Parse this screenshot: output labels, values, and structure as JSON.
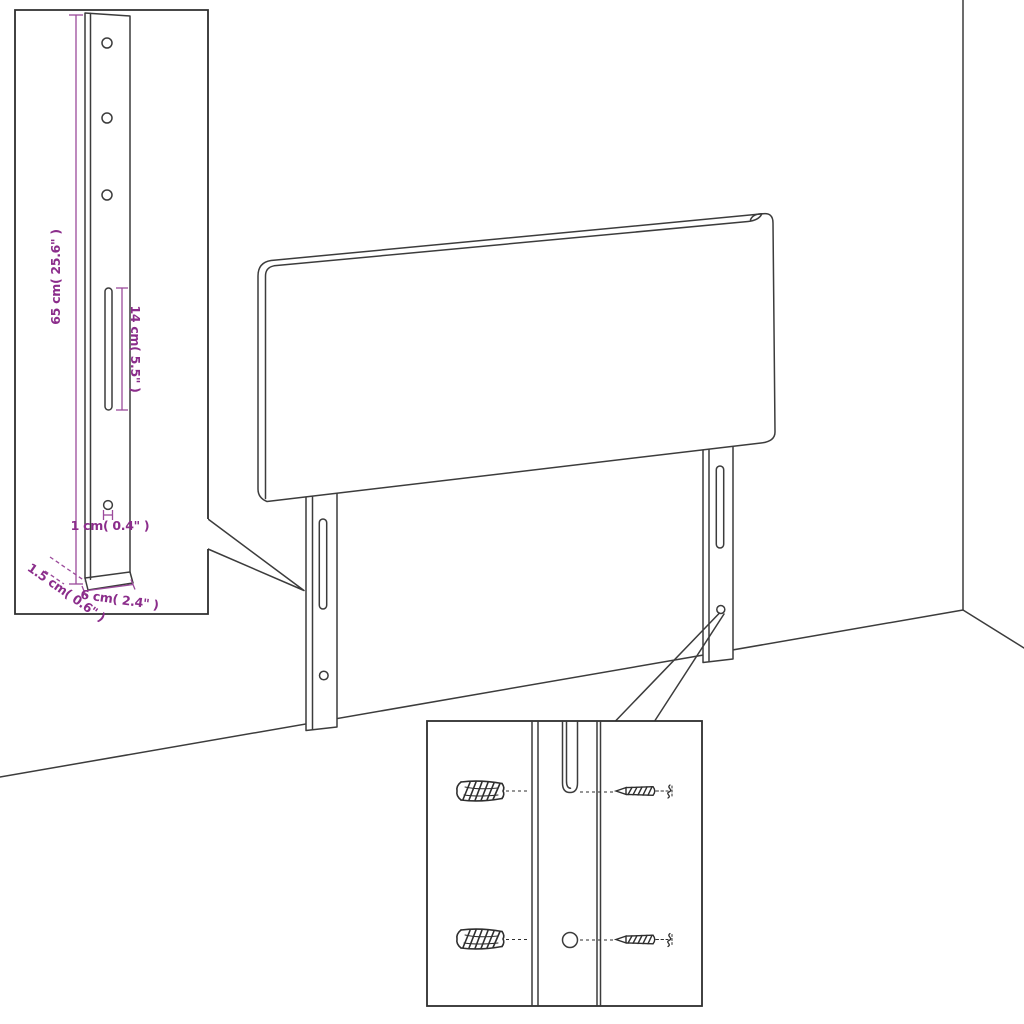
{
  "diagram": {
    "type": "furniture-assembly-dimension-diagram",
    "subject": "headboard with two mounting legs in room corner"
  },
  "colors": {
    "background": "#ffffff",
    "line": "#3c3c3c",
    "detail_box_border": "#2e2e2e",
    "dimension_line": "#9b4a9b",
    "dimension_text": "#8b2d8b"
  },
  "annotations": {
    "height": "65 cm( 25.6\" )",
    "slot_length": "14 cm( 5.5\" )",
    "hole_diameter": "1 cm( 0.4\" )",
    "depth": "1.5 cm( 0.6\" )",
    "width": "6 cm( 2.4\" )"
  }
}
